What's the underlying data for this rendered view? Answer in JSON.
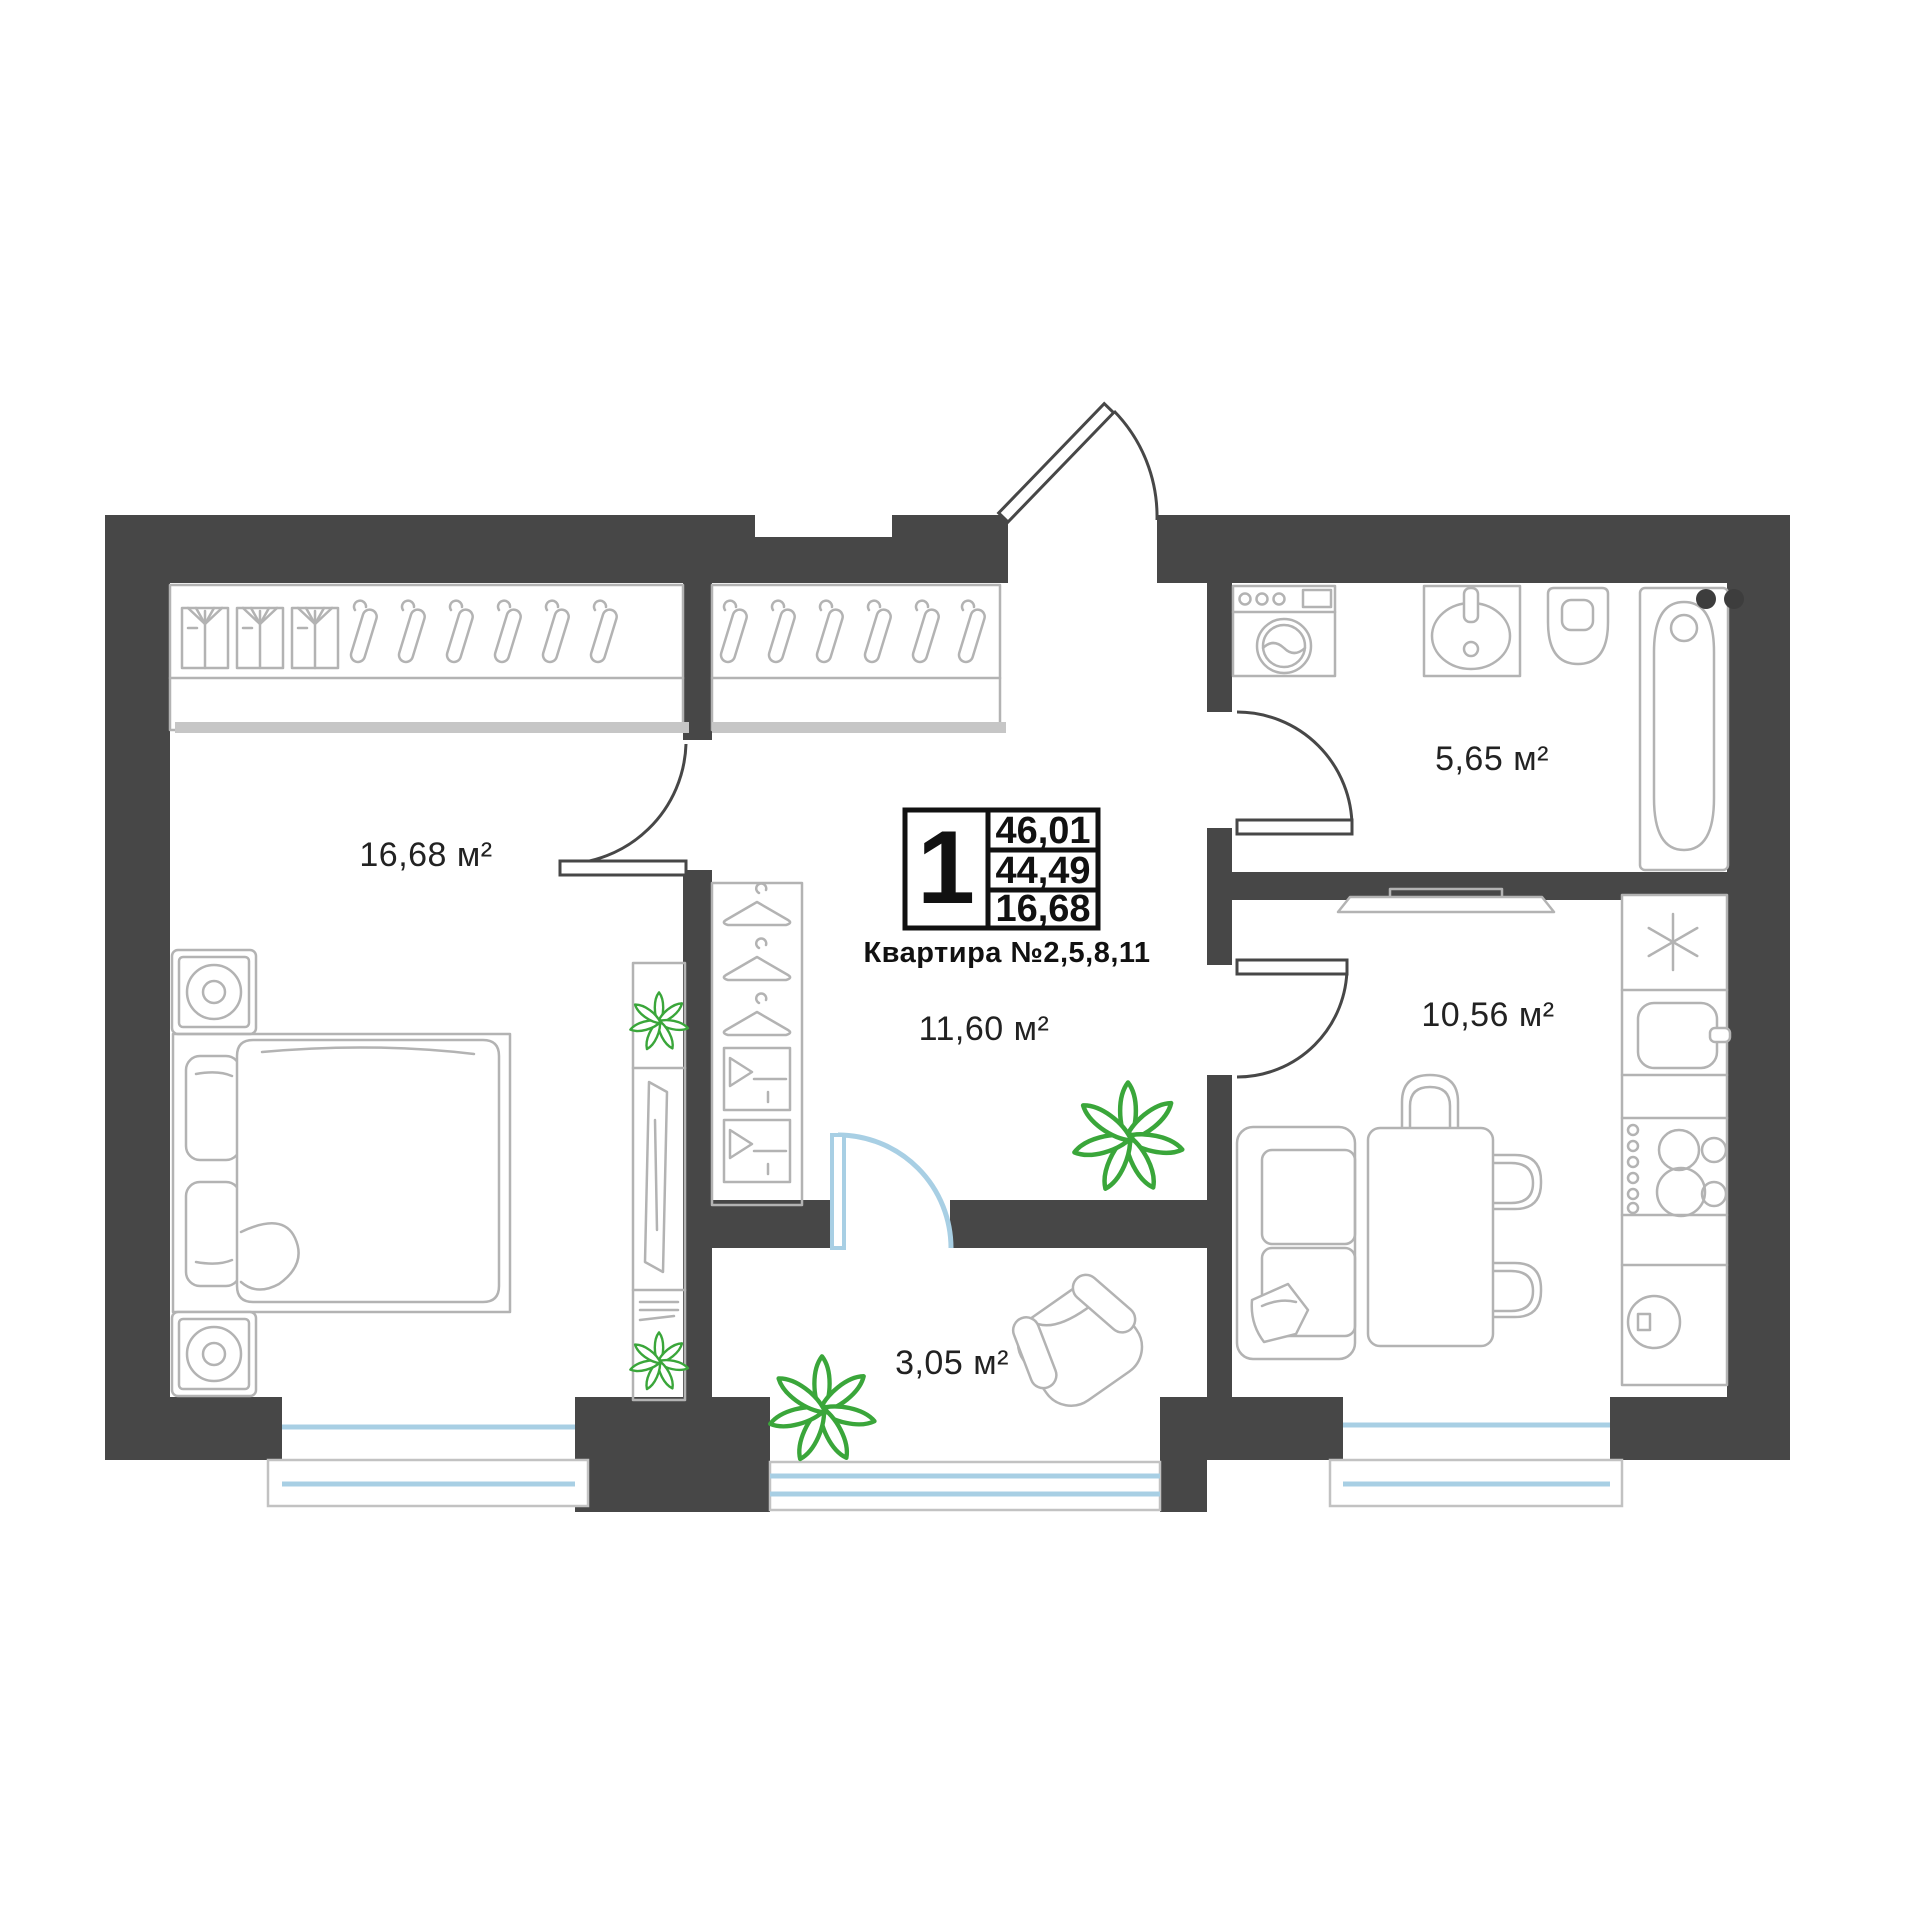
{
  "info_box": {
    "rooms_count": "1",
    "stats": [
      "46,01",
      "44,49",
      "16,68"
    ],
    "apartment_label": "Квартира №2,5,8,11"
  },
  "rooms": {
    "bedroom": "16,68 м²",
    "bathroom": "5,65 м²",
    "hallway": "11,60 м²",
    "kitchen": "10,56 м²",
    "balcony": "3,05 м²"
  },
  "colors": {
    "wall": "#474747",
    "furniture_line": "#b3b3b3",
    "glass_blue": "#a8cfe4",
    "plant_green": "#3aa63a",
    "text": "#222222",
    "info_border": "#111111"
  },
  "icons": [
    "wardrobe-hangers-icon",
    "shirt-icon",
    "washing-machine-icon",
    "bath-sink-icon",
    "toilet-icon",
    "bathtub-icon",
    "bed-icon",
    "nightstand-lamp-icon",
    "tv-stand-icon",
    "mini-closet-icon",
    "plant-icon",
    "sofa-icon",
    "dining-table-icon",
    "chair-icon",
    "fridge-snowflake-icon",
    "kitchen-sink-icon",
    "stove-icon",
    "cabinet-icon",
    "armchair-icon",
    "door-arc-icon",
    "window-icon"
  ]
}
